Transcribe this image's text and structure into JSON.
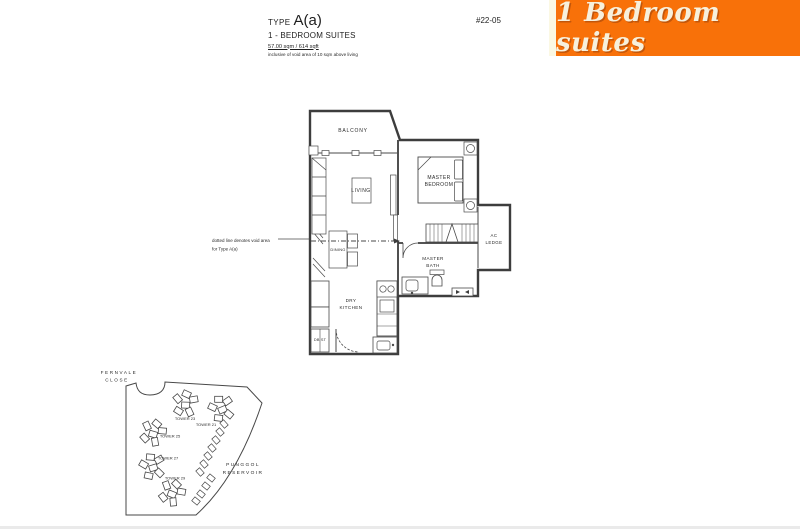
{
  "header": {
    "type_label": "TYPE",
    "type_value": "A(a)",
    "subtitle": "1 - BEDROOM SUITES",
    "area": "57.00 sqm / 614 sqft",
    "note": "inclusive of void area of 10 sqm above living",
    "unit_number": "#22-05"
  },
  "banner": {
    "text": "1 Bedroom suites",
    "bg_color": "#F87109",
    "stripe_color": "#FBF8E3",
    "text_color": "#F7F0DC"
  },
  "floorplan": {
    "labels": {
      "balcony": "BALCONY",
      "living": "LIVING",
      "master_bedroom": [
        "MASTER",
        "BEDROOM"
      ],
      "dining": "DINING",
      "master_bath": [
        "MASTER",
        "BATH"
      ],
      "dry_kitchen": [
        "DRY",
        "KITCHEN"
      ],
      "ac_ledge": [
        "AC",
        "LEDGE"
      ],
      "db_st": "DB ST"
    },
    "annotation": [
      "dotted line denotes void area",
      "for Type A(a)"
    ]
  },
  "sitemap": {
    "road": [
      "FERNVALE",
      "CLOSE"
    ],
    "water": [
      "PUNGGOL",
      "RESERVOIR"
    ],
    "towers": [
      "TOWER 23",
      "TOWER 21",
      "TOWER 25",
      "TOWER 27",
      "TOWER 29"
    ]
  }
}
